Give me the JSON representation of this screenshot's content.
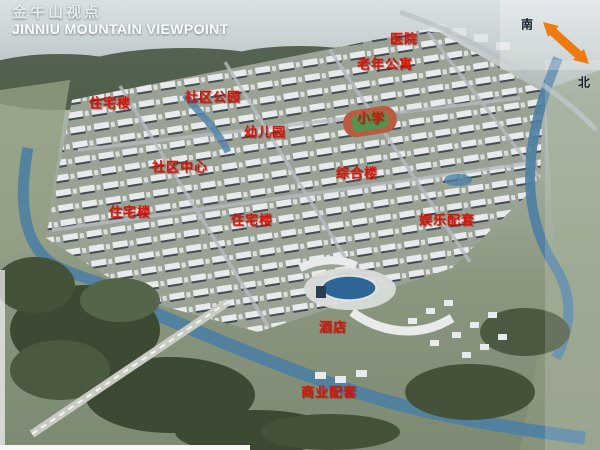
{
  "title": {
    "zh": "金牛山视点",
    "en": "JINNIU MOUNTAIN VIEWPOINT"
  },
  "compass": {
    "south_label": "南",
    "north_label": "北"
  },
  "map_labels": [
    {
      "id": "hospital",
      "text": "医院"
    },
    {
      "id": "senior-apartments",
      "text": "老年公寓"
    },
    {
      "id": "residential-building-1",
      "text": "住宅楼"
    },
    {
      "id": "community-park",
      "text": "社区公园"
    },
    {
      "id": "kindergarten",
      "text": "幼儿园"
    },
    {
      "id": "primary-school",
      "text": "小学"
    },
    {
      "id": "community-center",
      "text": "社区中心"
    },
    {
      "id": "mixed-use-building",
      "text": "综合楼"
    },
    {
      "id": "residential-building-2",
      "text": "住宅楼"
    },
    {
      "id": "residential-building-3",
      "text": "住宅楼"
    },
    {
      "id": "entertainment-facilities",
      "text": "娱乐配套"
    },
    {
      "id": "hotel",
      "text": "酒店"
    },
    {
      "id": "commercial-facilities",
      "text": "商业配套"
    }
  ],
  "colors": {
    "label_red": "#dc1407",
    "compass_orange": "#ee7a12",
    "river_blue": "#4d7fa3",
    "title_white": "#ffffff"
  }
}
